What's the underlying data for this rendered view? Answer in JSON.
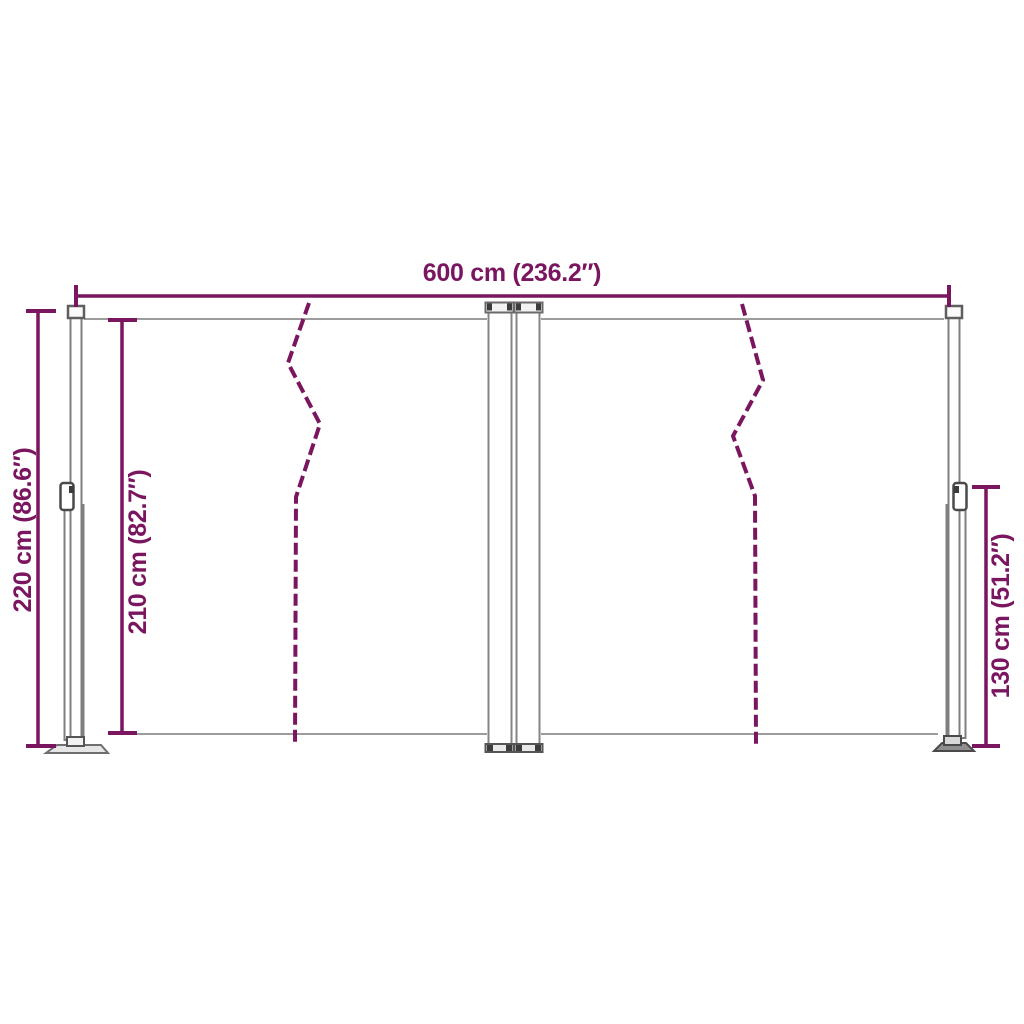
{
  "colors": {
    "dimension_accent": "#7A165F",
    "frame_light": "#9C9C9C",
    "frame_mid": "#7F7F7F",
    "frame_dark": "#3C3C3C",
    "background": "#FFFFFF"
  },
  "dimensions": {
    "total_width": {
      "label": "600 cm (236.2″)",
      "cm": 600,
      "inches": 236.2
    },
    "total_height": {
      "label": "220 cm (86.6″)",
      "cm": 220,
      "inches": 86.6
    },
    "inner_height": {
      "label": "210 cm (82.7″)",
      "cm": 210,
      "inches": 82.7
    },
    "post_height": {
      "label": "130 cm (51.2″)",
      "cm": 130,
      "inches": 51.2
    }
  }
}
